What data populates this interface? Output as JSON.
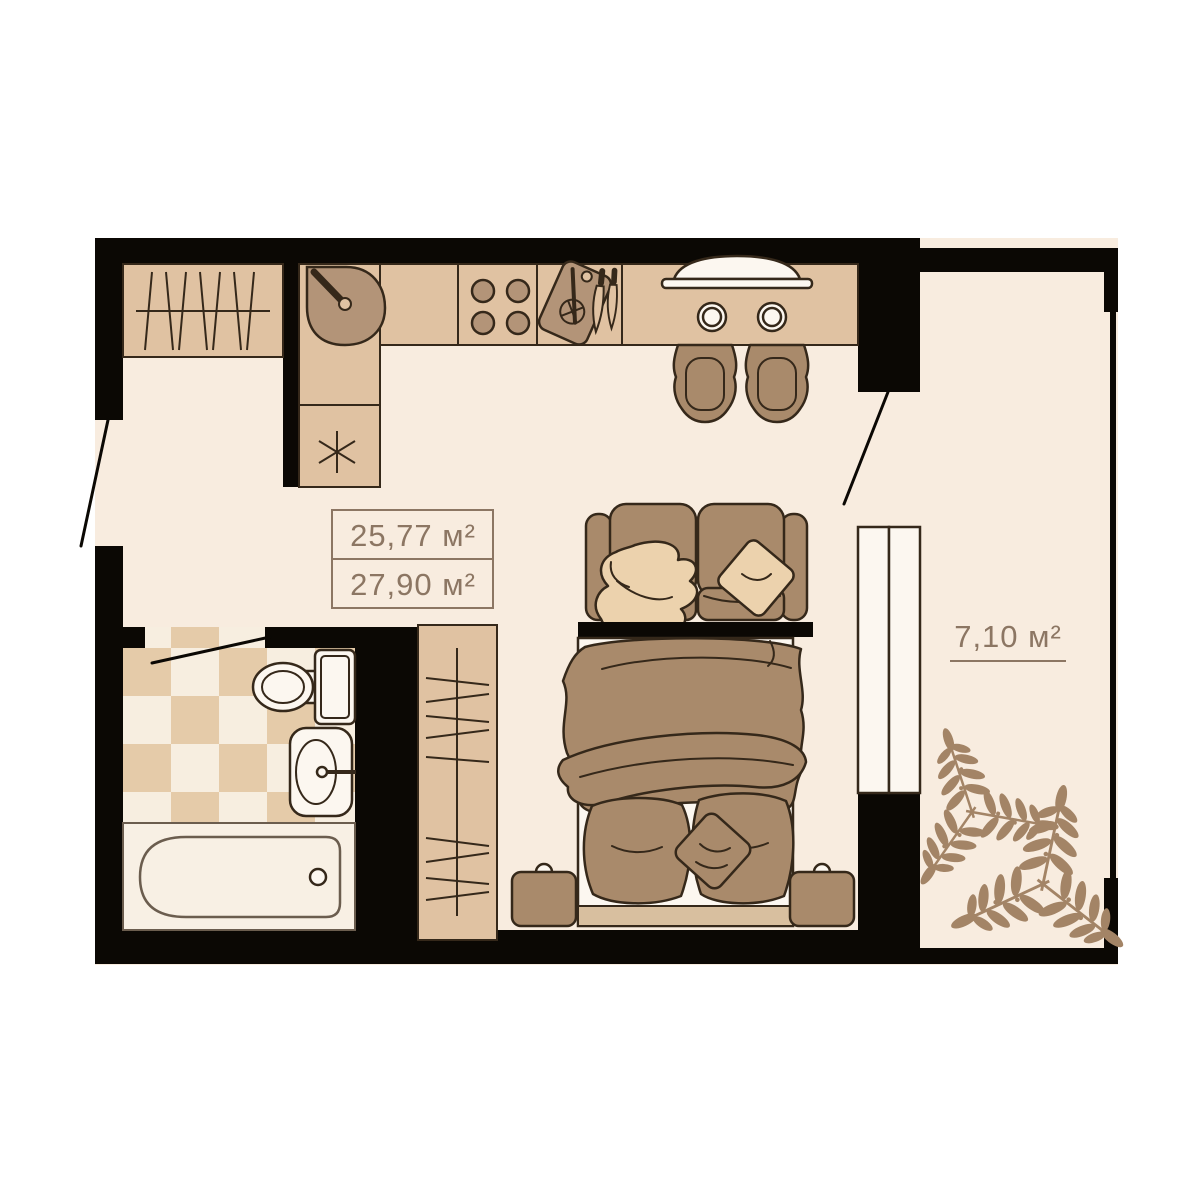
{
  "plan": {
    "unit_suffix": "м²",
    "labels": {
      "living_area": "25,77 м²",
      "total_area": "27,90 м²",
      "balcony_area": "7,10 м²"
    }
  },
  "colors": {
    "background": "#ffffff",
    "floor": "#f8ecdf",
    "wall": "#0b0804",
    "outline": "#35281a",
    "counter_tan": "#e0c2a2",
    "prep_brown": "#b39478",
    "furniture_brown": "#a98a6b",
    "pillow_light": "#ecd2ad",
    "fixture_white": "#fcf7f0",
    "fixture_cream": "#f8f0e4",
    "tub_line": "#6b5d4e",
    "tile_tan": "#e5cba9",
    "tile_cream": "#f7eee0",
    "bed_base": "#d8bf9f",
    "plant": "#a38466",
    "label_text": "#8c7663"
  }
}
